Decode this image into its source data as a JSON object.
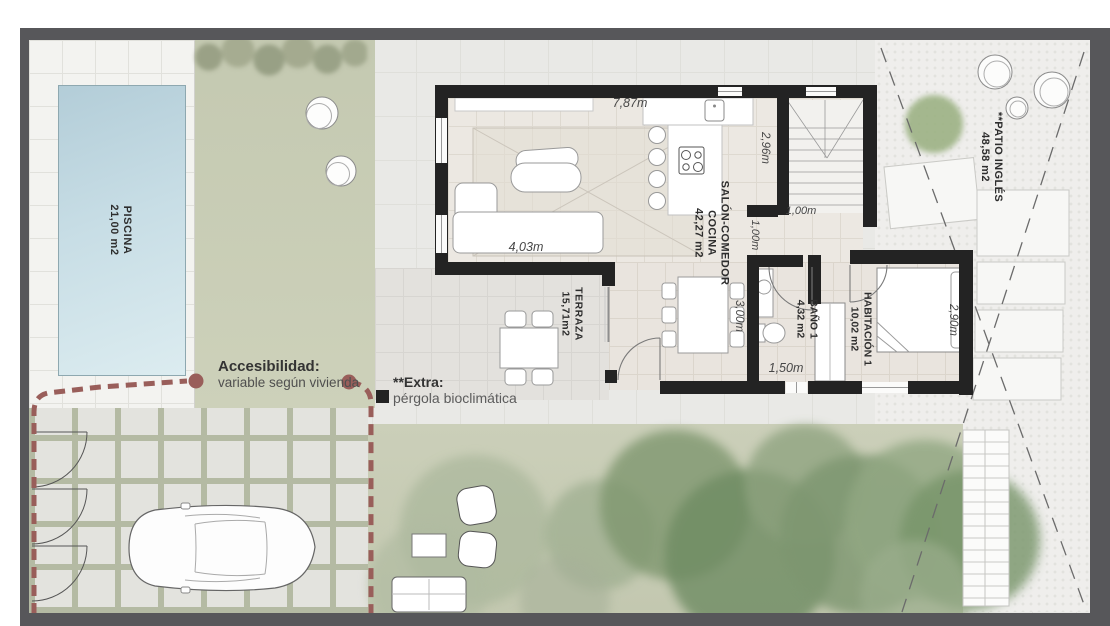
{
  "plan": {
    "type": "villa-ground-floor-plan",
    "rooms": {
      "piscina": {
        "name": "PISCINA",
        "area": "21,00 m2"
      },
      "salon_comedor": {
        "line1": "SALÓN-COMEDOR",
        "line2": "COCINA",
        "area": "42,27 m2"
      },
      "terraza": {
        "name": "TERRAZA",
        "area": "15,71m2"
      },
      "bano1": {
        "name": "BAÑO 1",
        "area": "4,32 m2"
      },
      "habitacion1": {
        "name": "HABITACIÓN 1",
        "area": "10,02 m2"
      },
      "patio_ingles": {
        "name": "**PATIO INGLÉS",
        "area": "48,58 m2"
      }
    },
    "dimensions": {
      "salon_width": "7,87m",
      "sofa_width": "4,03m",
      "stairs_depth": "2,96m",
      "stairs_width": "1,00m",
      "hall_width": "1,00m",
      "comedor_depth": "3,00m",
      "bano_width": "1,50m",
      "habitacion_depth": "2,90m"
    },
    "annotations": {
      "accessibility_title": "Accesibilidad:",
      "accessibility_note": "variable según vivienda",
      "extra_title": "**Extra:",
      "extra_note": "pérgola bioclimática"
    },
    "colors": {
      "wall": "#232323",
      "frame": "#57575a",
      "pool": "#bed7e0",
      "garden": "#c7cbb4",
      "gravel": "#efeeec",
      "accessibility_line": "#995e5a"
    }
  }
}
